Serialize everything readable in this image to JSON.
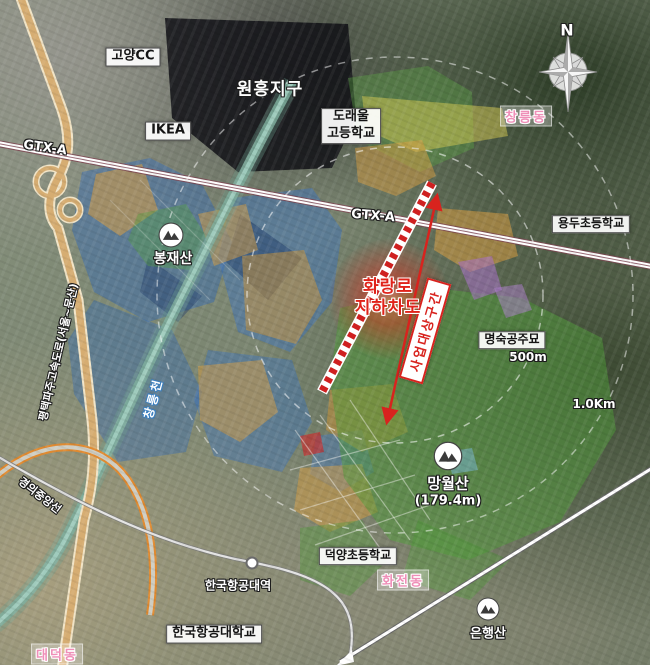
{
  "title": "화랑로 지하차도 사업구간 위치도",
  "labels": {
    "golf_club": "고양CC",
    "wonheung_district": "원흥지구",
    "ikea": "IKEA",
    "doraeul_line1": "도래울",
    "doraeul_line2": "고등학교",
    "changneung_dong": "창릉동",
    "compass_n": "N",
    "gtx_a_left": "GTX-A",
    "gtx_a_center": "GTX-A",
    "yongdu_school": "용두초등학교",
    "bongjaesan": "봉재산",
    "underpass_line1": "화랑로",
    "underpass_line2": "지하차도",
    "project_section": "사업대상구간",
    "myeongsuk_tomb": "명숙공주묘",
    "dist_500m": "500m",
    "dist_1km": "1.0Km",
    "mangwolsan_line1": "망월산",
    "mangwolsan_line2": "(179.4m)",
    "deokyang_school": "덕양초등학교",
    "hwajeon_dong": "화전동",
    "kau_station": "한국항공대역",
    "kau_university": "한국항공대학교",
    "eunhaengsan": "은행산",
    "daedeok_dong": "대덕동",
    "gyeongui_line": "경의중앙선",
    "expressway": "평택파주고속도로(서울~문산)",
    "changneung_stream": "창릉천"
  },
  "map_colors": {
    "overlay_blue": "#3a6cb0",
    "overlay_dark_blue": "#1d3a68",
    "overlay_orange": "#d79d42",
    "overlay_green": "#4f9c3a",
    "overlay_yellow": "#d5ca52",
    "overlay_purple": "#a86fc8",
    "overlay_red": "#c43030",
    "overlay_skyblue": "#7ab8d8",
    "highlight_red": "#d8231e",
    "dong_label_pink": "#ef8fb8",
    "gtx_line_white": "#ffffff",
    "expressway_tan": "#d6ad72"
  }
}
